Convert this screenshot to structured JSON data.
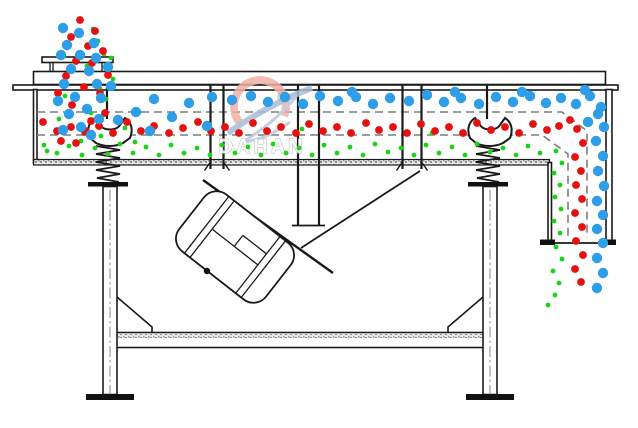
{
  "watermark": {
    "brand": "DAHAN",
    "registered": "®"
  },
  "colors": {
    "coarse": "#2E9EE8",
    "medium": "#E8100E",
    "fine": "#1BD215",
    "line": "#1a1a1a",
    "dash": "#7d7d7d",
    "watermark_pink": "#f0b2a3",
    "watermark_blue": "#a9bdd6",
    "watermark_text_fill": "#fdfdfd",
    "watermark_text_stroke": "#b8b8b8"
  },
  "particles": {
    "coarse_blue": {
      "color_key": "coarse",
      "r": 5.2,
      "points": [
        [
          63,
          28
        ],
        [
          79,
          33
        ],
        [
          94,
          43
        ],
        [
          67,
          45
        ],
        [
          61,
          55
        ],
        [
          80,
          55
        ],
        [
          96,
          58
        ],
        [
          71,
          69
        ],
        [
          89,
          71
        ],
        [
          108,
          67
        ],
        [
          64,
          84
        ],
        [
          97,
          84
        ],
        [
          111,
          86
        ],
        [
          75,
          97
        ],
        [
          101,
          98
        ],
        [
          58,
          101
        ],
        [
          87,
          109
        ],
        [
          69,
          114
        ],
        [
          99,
          119
        ],
        [
          81,
          127
        ],
        [
          63,
          130
        ],
        [
          91,
          135
        ],
        [
          118,
          120
        ],
        [
          136,
          112
        ],
        [
          154,
          99
        ],
        [
          150,
          131
        ],
        [
          172,
          117
        ],
        [
          189,
          103
        ],
        [
          207,
          126
        ],
        [
          212,
          97
        ],
        [
          232,
          100
        ],
        [
          251,
          96
        ],
        [
          268,
          102
        ],
        [
          285,
          97
        ],
        [
          303,
          104
        ],
        [
          320,
          96
        ],
        [
          338,
          101
        ],
        [
          356,
          97
        ],
        [
          373,
          104
        ],
        [
          390,
          98
        ],
        [
          409,
          101
        ],
        [
          427,
          95
        ],
        [
          444,
          102
        ],
        [
          461,
          98
        ],
        [
          479,
          104
        ],
        [
          496,
          97
        ],
        [
          513,
          102
        ],
        [
          530,
          96
        ],
        [
          546,
          103
        ],
        [
          561,
          98
        ],
        [
          576,
          104
        ],
        [
          590,
          96
        ],
        [
          601,
          107
        ],
        [
          352,
          92
        ],
        [
          455,
          92
        ],
        [
          522,
          92
        ],
        [
          585,
          90
        ],
        [
          598,
          114
        ],
        [
          604,
          127
        ],
        [
          596,
          141
        ],
        [
          603,
          156
        ],
        [
          598,
          171
        ],
        [
          604,
          186
        ],
        [
          597,
          201
        ],
        [
          603,
          215
        ],
        [
          597,
          229
        ],
        [
          603,
          243
        ],
        [
          597,
          258
        ],
        [
          603,
          273
        ],
        [
          597,
          288
        ],
        [
          588,
          122
        ]
      ]
    },
    "medium_red": {
      "color_key": "medium",
      "r": 3.9,
      "points": [
        [
          80,
          20
        ],
        [
          95,
          31
        ],
        [
          71,
          37
        ],
        [
          88,
          46
        ],
        [
          103,
          51
        ],
        [
          76,
          61
        ],
        [
          92,
          63
        ],
        [
          108,
          75
        ],
        [
          66,
          76
        ],
        [
          84,
          87
        ],
        [
          100,
          93
        ],
        [
          72,
          105
        ],
        [
          58,
          93
        ],
        [
          91,
          121
        ],
        [
          105,
          113
        ],
        [
          61,
          141
        ],
        [
          76,
          143
        ],
        [
          86,
          131
        ],
        [
          43,
          122
        ],
        [
          57,
          131
        ],
        [
          71,
          127
        ],
        [
          85,
          132
        ],
        [
          99,
          126
        ],
        [
          113,
          133
        ],
        [
          127,
          122
        ],
        [
          141,
          131
        ],
        [
          154,
          126
        ],
        [
          169,
          133
        ],
        [
          183,
          128
        ],
        [
          198,
          122
        ],
        [
          211,
          131
        ],
        [
          225,
          127
        ],
        [
          239,
          133
        ],
        [
          253,
          123
        ],
        [
          267,
          131
        ],
        [
          281,
          127
        ],
        [
          296,
          133
        ],
        [
          309,
          124
        ],
        [
          323,
          131
        ],
        [
          337,
          127
        ],
        [
          351,
          133
        ],
        [
          366,
          123
        ],
        [
          379,
          130
        ],
        [
          393,
          127
        ],
        [
          407,
          133
        ],
        [
          421,
          124
        ],
        [
          435,
          131
        ],
        [
          449,
          127
        ],
        [
          463,
          133
        ],
        [
          477,
          123
        ],
        [
          491,
          130
        ],
        [
          505,
          127
        ],
        [
          519,
          133
        ],
        [
          533,
          124
        ],
        [
          547,
          130
        ],
        [
          559,
          126
        ],
        [
          570,
          120
        ],
        [
          577,
          129
        ],
        [
          583,
          143
        ],
        [
          575,
          157
        ],
        [
          581,
          171
        ],
        [
          576,
          185
        ],
        [
          582,
          199
        ],
        [
          575,
          213
        ],
        [
          582,
          227
        ],
        [
          576,
          241
        ],
        [
          583,
          255
        ],
        [
          575,
          269
        ],
        [
          581,
          282
        ]
      ]
    },
    "fine_green": {
      "color_key": "fine",
      "r": 2.4,
      "points": [
        [
          93,
          29
        ],
        [
          98,
          41
        ],
        [
          104,
          54
        ],
        [
          111,
          58
        ],
        [
          87,
          66
        ],
        [
          113,
          79
        ],
        [
          100,
          89
        ],
        [
          65,
          96
        ],
        [
          106,
          99
        ],
        [
          91,
          113
        ],
        [
          59,
          119
        ],
        [
          81,
          141
        ],
        [
          101,
          136
        ],
        [
          47,
          151
        ],
        [
          125,
          128
        ],
        [
          135,
          142
        ],
        [
          44,
          145
        ],
        [
          57,
          153
        ],
        [
          69,
          146
        ],
        [
          82,
          155
        ],
        [
          95,
          148
        ],
        [
          108,
          154
        ],
        [
          120,
          144
        ],
        [
          133,
          153
        ],
        [
          146,
          147
        ],
        [
          159,
          155
        ],
        [
          171,
          145
        ],
        [
          184,
          153
        ],
        [
          197,
          148
        ],
        [
          210,
          155
        ],
        [
          222,
          145
        ],
        [
          235,
          153
        ],
        [
          248,
          147
        ],
        [
          261,
          155
        ],
        [
          273,
          144
        ],
        [
          286,
          153
        ],
        [
          299,
          148
        ],
        [
          312,
          155
        ],
        [
          324,
          145
        ],
        [
          337,
          153
        ],
        [
          350,
          147
        ],
        [
          363,
          155
        ],
        [
          375,
          144
        ],
        [
          388,
          152
        ],
        [
          401,
          148
        ],
        [
          414,
          155
        ],
        [
          426,
          145
        ],
        [
          439,
          153
        ],
        [
          452,
          147
        ],
        [
          465,
          155
        ],
        [
          477,
          144
        ],
        [
          490,
          152
        ],
        [
          503,
          148
        ],
        [
          516,
          155
        ],
        [
          528,
          146
        ],
        [
          540,
          153
        ],
        [
          556,
          151
        ],
        [
          562,
          163
        ],
        [
          554,
          173
        ],
        [
          560,
          185
        ],
        [
          555,
          197
        ],
        [
          561,
          209
        ],
        [
          554,
          221
        ],
        [
          560,
          233
        ],
        [
          556,
          247
        ],
        [
          562,
          259
        ],
        [
          553,
          271
        ],
        [
          559,
          283
        ],
        [
          555,
          295
        ],
        [
          548,
          305
        ],
        [
          151,
          130
        ],
        [
          302,
          129
        ],
        [
          432,
          133
        ]
      ]
    }
  }
}
